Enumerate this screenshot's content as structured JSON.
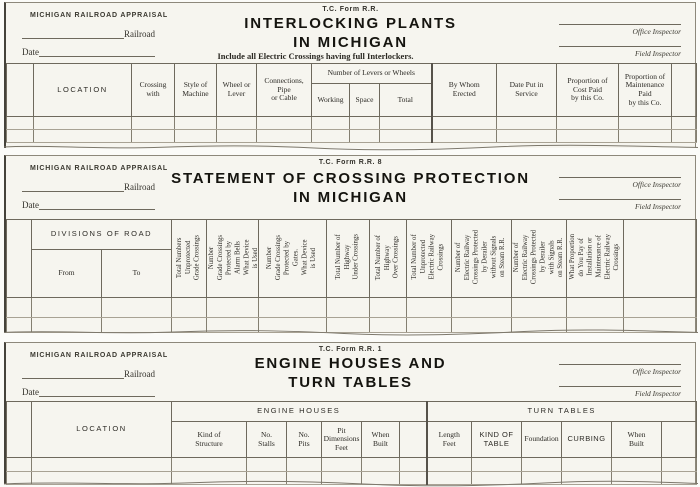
{
  "colors": {
    "paper": "#f6f5ef",
    "page_background": "#fbfbf8",
    "grid_line": "#6e695d",
    "ink": "#262420"
  },
  "form1": {
    "appraisal": "MICHIGAN RAILROAD APPRAISAL",
    "railroad_label": "Railroad",
    "date_label": "Date",
    "form_no": "T.C. Form R.R.",
    "title": "INTERLOCKING PLANTS\nIN MICHIGAN",
    "subtitle": "Include all Electric Crossings having full Interlockers.",
    "office_inspector": "Office Inspector",
    "field_inspector": "Field Inspector",
    "headers": {
      "location": "LOCATION",
      "crossing_with": "Crossing\nwith",
      "style_of_machine": "Style of\nMachine",
      "wheel_or_lever": "Wheel or\nLever",
      "connections": "Connections,\nPipe\nor Cable",
      "levers_group": "Number of Levers or Wheels",
      "working": "Working",
      "space": "Space",
      "total": "Total",
      "by_whom_erected": "By Whom\nErected",
      "date_put_in_service": "Date Put in\nService",
      "proportion_cost": "Proportion of\nCost Paid\nby this Co.",
      "proportion_maintenance": "Proportion of\nMaintenance\nPaid\nby this Co."
    }
  },
  "form2": {
    "appraisal": "MICHIGAN RAILROAD APPRAISAL",
    "railroad_label": "Railroad",
    "date_label": "Date",
    "form_no": "T.C. Form R.R. 8",
    "title": "STATEMENT OF CROSSING PROTECTION\nIN MICHIGAN",
    "office_inspector": "Office Inspector",
    "field_inspector": "Field Inspector",
    "headers": {
      "divisions_of_road": "DIVISIONS OF ROAD",
      "from": "From",
      "to": "To",
      "vertical": [
        "Total Numbers\nUnprotected\nGrade Crossings",
        "Number\nGrade Crossings\nProtected by\nAlarm Bells\nWhat Device\nis Used",
        "Number\nGrade Crossings\nProtected by\nGates.\nWhat Device\nis Used",
        "Total Number of\nHighway\nUnder Crossings",
        "Total Number of\nHighway\nOver Crossings",
        "Total Number of\nUnprotected\nElectric Railway\nCrossings",
        "Number of\nElectric Railway\nCrossings Protected\nby Derailer\nwithout Signals\non Steam R.R.",
        "Number of\nElectric Railway\nCrossings Protected\nby Derailer\nwith Signals\non Steam R.R.",
        "What Proportion\ndo You Pay of\nInstallation or\nMaintenance of\nElectric Railway\nCrossings"
      ]
    }
  },
  "form3": {
    "appraisal": "MICHIGAN RAILROAD APPRAISAL",
    "railroad_label": "Railroad",
    "date_label": "Date",
    "form_no": "T.C. Form R.R. 1",
    "title": "ENGINE HOUSES AND\nTURN TABLES",
    "office_inspector": "Office Inspector",
    "field_inspector": "Field Inspector",
    "headers": {
      "location": "LOCATION",
      "engine_houses_group": "ENGINE HOUSES",
      "turn_tables_group": "TURN TABLES",
      "kind_of_structure": "Kind of\nStructure",
      "no_stalls": "No.\nStalls",
      "no_pits": "No.\nPits",
      "pit_dimensions": "Pit\nDimensions\nFeet",
      "when_built_engine": "When\nBuilt",
      "length_feet": "Length\nFeet",
      "kind_of_table": "KIND OF\nTABLE",
      "foundation": "Foundation",
      "curbing": "CURBING",
      "when_built_turn": "When\nBuilt"
    }
  }
}
